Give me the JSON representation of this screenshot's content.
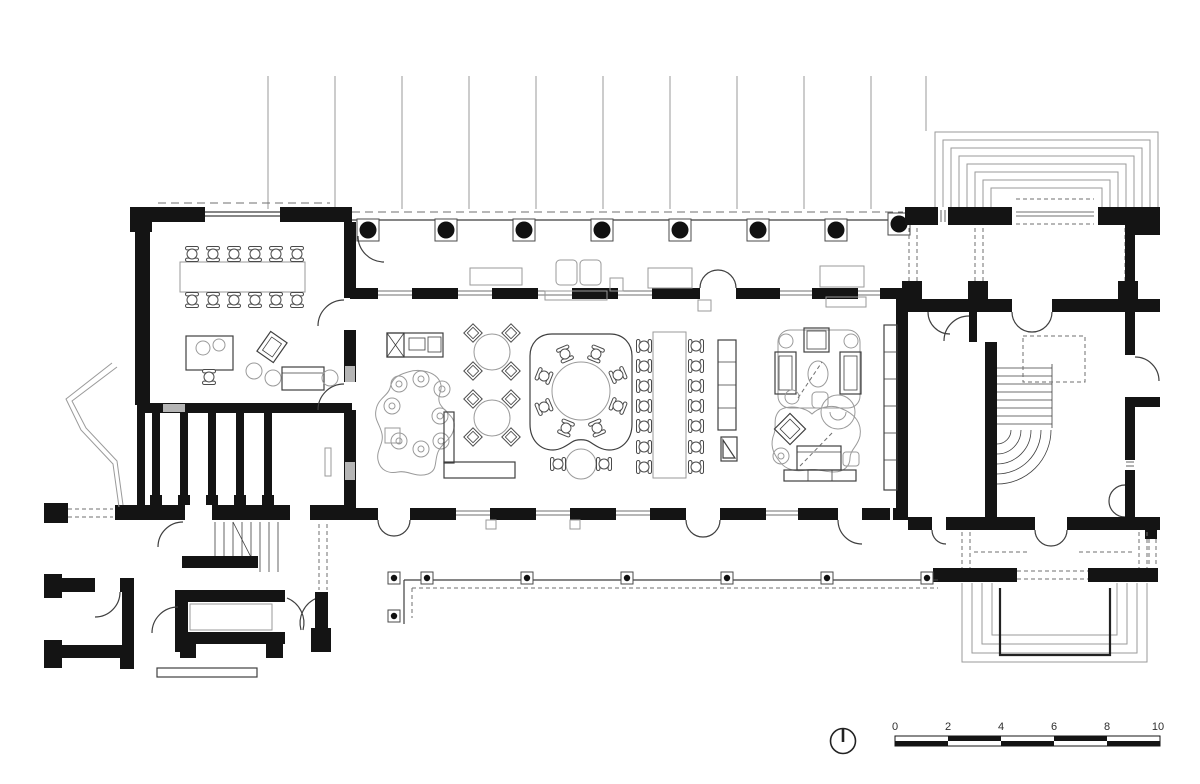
{
  "drawing": {
    "type": "architectural-floor-plan"
  },
  "scale_bar": {
    "unit_labels": [
      "0",
      "2",
      "4",
      "6",
      "8",
      "10"
    ]
  },
  "symbols": {
    "orientation_marker": "circle-with-12-oclock-hand",
    "column": "filled-circle-in-square",
    "pergola_post": "dot-in-square"
  },
  "colors": {
    "background": "#ffffff",
    "wall": "#141414",
    "line": "#3f3f3f",
    "light_line": "#9a9a9a",
    "dash": "#6f6f6f",
    "text": "#2e2e2e"
  }
}
